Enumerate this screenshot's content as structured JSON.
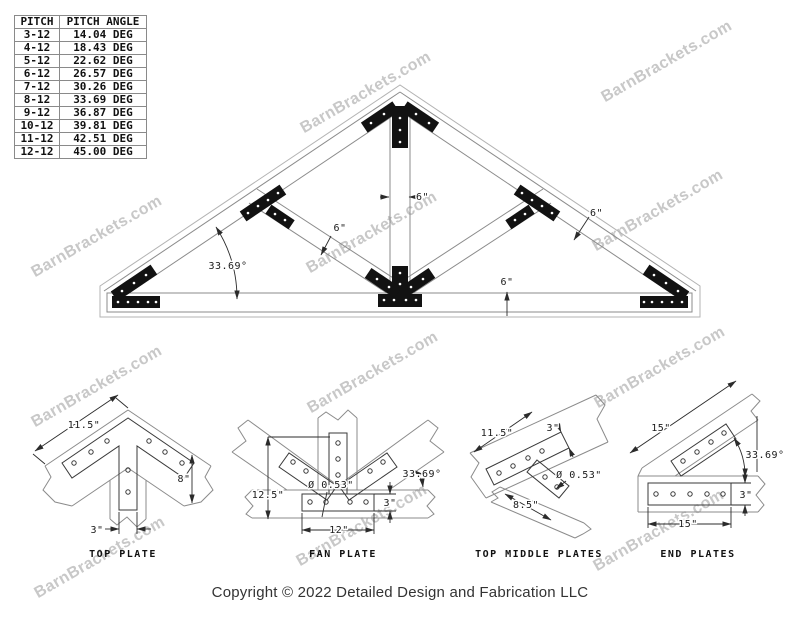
{
  "watermark": {
    "text": "BarnBrackets.com",
    "color": "#c8c8c8",
    "positions": [
      {
        "x": 667,
        "y": 62
      },
      {
        "x": 658,
        "y": 211
      },
      {
        "x": 660,
        "y": 368
      },
      {
        "x": 659,
        "y": 531
      },
      {
        "x": 366,
        "y": 93
      },
      {
        "x": 372,
        "y": 233
      },
      {
        "x": 373,
        "y": 373
      },
      {
        "x": 362,
        "y": 526
      },
      {
        "x": 97,
        "y": 237
      },
      {
        "x": 97,
        "y": 387
      },
      {
        "x": 100,
        "y": 558
      }
    ]
  },
  "pitch_table": {
    "headers": [
      "PITCH",
      "PITCH ANGLE"
    ],
    "rows": [
      [
        "3-12",
        "14.04 DEG"
      ],
      [
        "4-12",
        "18.43 DEG"
      ],
      [
        "5-12",
        "22.62 DEG"
      ],
      [
        "6-12",
        "26.57 DEG"
      ],
      [
        "7-12",
        "30.26 DEG"
      ],
      [
        "8-12",
        "33.69 DEG"
      ],
      [
        "9-12",
        "36.87 DEG"
      ],
      [
        "10-12",
        "39.81 DEG"
      ],
      [
        "11-12",
        "42.51 DEG"
      ],
      [
        "12-12",
        "45.00 DEG"
      ]
    ]
  },
  "truss_diagram": {
    "dimensions": {
      "king_post_width": "6\"",
      "rafter_thickness": "6\"",
      "web_thickness": "6\"",
      "chord_thickness": "6\"",
      "pitch_angle": "33.69°"
    }
  },
  "details": {
    "top_plate": {
      "caption": "TOP PLATE",
      "dims": {
        "arm_length": "11.5\"",
        "beam_height": "8\"",
        "stem_width": "3\""
      }
    },
    "fan_plate": {
      "caption": "FAN PLATE",
      "dims": {
        "height": "12.5\"",
        "hole_diameter": "Ø 0.53\"",
        "bar_height": "3\"",
        "bar_length": "12\"",
        "angle": "33.69°"
      }
    },
    "top_middle_plates": {
      "caption": "TOP MIDDLE PLATES",
      "dims": {
        "bar_length": "11.5\"",
        "bar_width": "3\"",
        "hole_diameter": "Ø 0.53\"",
        "stem_length": "8.5\""
      }
    },
    "end_plates": {
      "caption": "END PLATES",
      "dims": {
        "rafter_length": "15\"",
        "angle": "33.69°",
        "bar_height": "3\"",
        "base_length": "15\""
      }
    }
  },
  "footer": {
    "copyright": "Copyright © 2022 Detailed Design and Fabrication LLC"
  }
}
